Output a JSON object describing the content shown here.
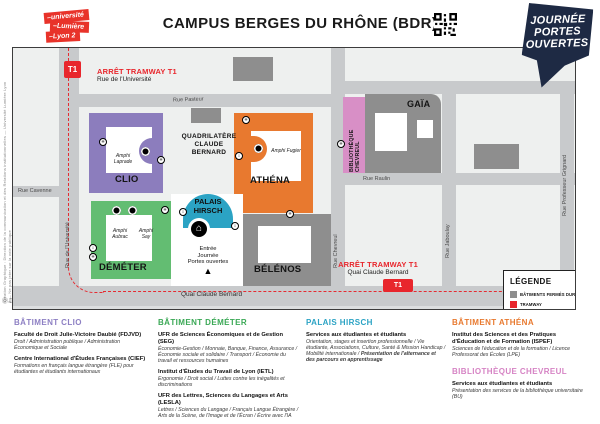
{
  "header": {
    "logo": {
      "lines": [
        "–université",
        "–Lumière",
        "–Lyon 2"
      ]
    },
    "title": "CAMPUS BERGES DU RHÔNE (BDR)",
    "jpo_badge": {
      "lines": [
        "JOURNÉE",
        "PORTES",
        "OUVERTES"
      ]
    }
  },
  "colors": {
    "clio_purple": "#8c7dbd",
    "demeter_green": "#63bd72",
    "athena_orange": "#e8792f",
    "palais_teal": "#2ba3c4",
    "chevreul_pink": "#d88fc6",
    "closed_gray": "#8e8e8e",
    "tram_red": "#e8262c",
    "badge_navy": "#1e2a44"
  },
  "map": {
    "streets": {
      "pasteur": "Rue Pasteur",
      "cavenne": "Rue Cavenne",
      "universite": "Rue de l'Université",
      "quai": "Quai Claude Bernard",
      "raulin": "Rue Raulin",
      "chevreul": "Rue Chevreul",
      "jaboulay": "Rue Jaboulay",
      "grignard": "Rue Professeur Grignard"
    },
    "tram": {
      "line_label": "T1",
      "stop_left": {
        "title": "ARRÊT TRAMWAY T1",
        "subtitle": "Rue de l'Université"
      },
      "stop_right": {
        "title": "ARRÊT TRAMWAY T1",
        "subtitle": "Quai Claude Bernard"
      }
    },
    "quadrilatere": {
      "lines": [
        "QUADRILATÈRE",
        "CLAUDE",
        "BERNARD"
      ]
    },
    "buildings": {
      "clio": {
        "name": "CLIO",
        "amphi": "Amphi Laprade"
      },
      "demeter": {
        "name": "DÉMÉTER",
        "amphi1": "Amphi Aubrac",
        "amphi2": "Amphi Say"
      },
      "palais": {
        "name_lines": [
          "PALAIS",
          "HIRSCH"
        ]
      },
      "belenos": {
        "name": "BÉLÉNOS"
      },
      "athena": {
        "name": "ATHÉNA",
        "amphi": "Amphi Fugier"
      },
      "gaia": {
        "name": "GAÏA"
      },
      "chevreul_lib": {
        "name_lines": [
          "BIBLIOTHÈQUE",
          "CHEVREUL"
        ]
      }
    },
    "entrance": {
      "lines": [
        "Entrée",
        "Journée",
        "Portes ouvertes"
      ],
      "marker": "▲"
    }
  },
  "legend": {
    "title": "LÉGENDE",
    "items": [
      {
        "label": "BÂTIMENTS FERMÉS DURANT LA JPO"
      },
      {
        "label": "TRAMWAY"
      },
      {
        "label": "ÉLÉVATEUR",
        "glyph": "↕"
      },
      {
        "label": "ASCENSEUR",
        "glyph": "✳"
      },
      {
        "label": "ACCUEIL JPO"
      }
    ]
  },
  "sections": [
    {
      "title": "BÂTIMENT CLIO",
      "entries": [
        {
          "name": "Faculté de Droit Julie-Victoire Daubié (FDJVD)",
          "desc": "Droit / Administration publique / Administration Économique et Sociale"
        },
        {
          "name": "Centre International d'Études Françaises (CIEF)",
          "desc": "Formations en français langue étrangère (FLE) pour étudiantes et étudiants internationaux"
        }
      ]
    },
    {
      "title": "BÂTIMENT DÉMÉTER",
      "entries": [
        {
          "name": "UFR de Sciences Économiques et de Gestion (SEG)",
          "desc": "Économie-Gestion / Monnaie, Banque, Finance, Assurance / Économie sociale et solidaire / Transport / Économie du travail et ressources humaines"
        },
        {
          "name": "Institut d'Études du Travail de Lyon (IETL)",
          "desc": "Ergonomie / Droit social / Luttes contre les inégalités et discriminations"
        },
        {
          "name": "UFR des Lettres, Sciences du Langages et Arts (LESLA)",
          "desc": "Lettres / Sciences du Langage / Français Langue Étrangère / Arts de la Scène, de l'Image et de l'Écran / Écrire avec l'IA"
        }
      ]
    },
    {
      "title": "PALAIS HIRSCH",
      "entries": [
        {
          "name": "Services aux étudiantes et étudiants",
          "desc": "Orientation, stages et insertion professionnelle / Vie étudiante, Associations, Culture, Santé & Mission Handicap / Mobilité internationale /",
          "desc_bold": "Présentation de l'alternance et des parcours en apprentissage"
        }
      ]
    },
    {
      "title": "BÂTIMENT ATHÉNA",
      "entries": [
        {
          "name": "Institut des Sciences et des Pratiques d'Éducation et de Formation (ISPEF)",
          "desc": "Sciences de l'éducation et de la formation / Licence Professorat des Écoles (LPE)"
        }
      ]
    },
    {
      "title": "BIBLIOTHÈQUE CHEVREUL",
      "entries": [
        {
          "name": "Services aux étudiantes et étudiants",
          "desc": "Présentation des services de la bibliothèque universitaire (BU)"
        }
      ]
    }
  ],
  "footer_credit": "Création Graphique : Direction de la communication et des Relations institutionnelles — Université Lumière Lyon 2 — Ne pas jeter sur la voie publique",
  "license_glyphs": "Ⓞ▥"
}
